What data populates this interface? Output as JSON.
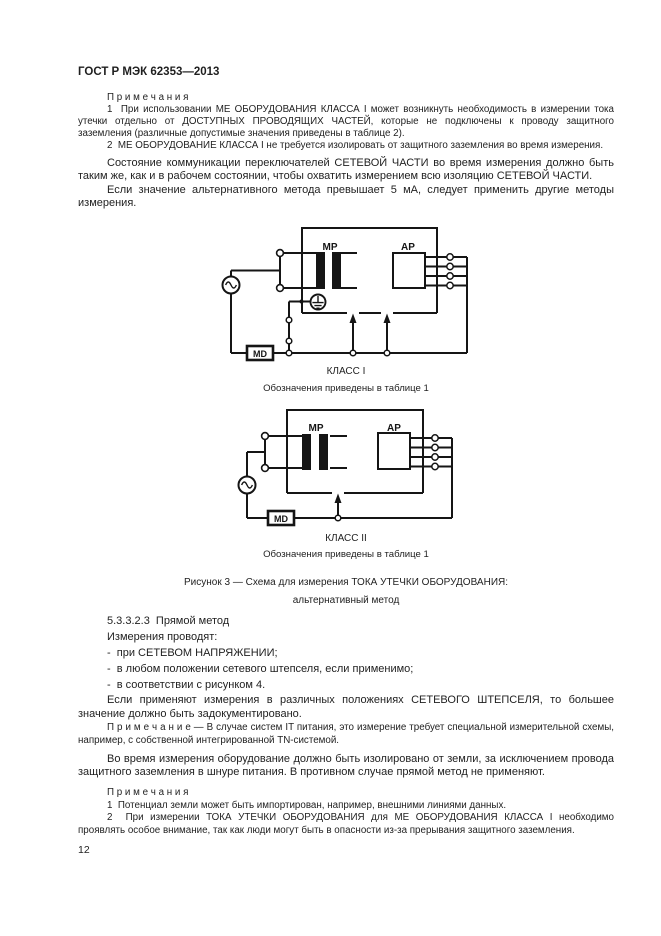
{
  "header": {
    "title": "ГОСТ Р МЭК 62353—2013"
  },
  "notes_top": {
    "label": "П р и м е ч а н и я",
    "items": [
      "1  При использовании МЕ ОБОРУДОВАНИЯ КЛАССА I может возникнуть необходимость в измерении тока утечки отдельно от ДОСТУПНЫХ ПРОВОДЯЩИХ ЧАСТЕЙ, которые не подключены к проводу защитного заземления (различные допустимые значения приведены в таблице 2).",
      "2  МЕ ОБОРУДОВАНИЕ КЛАССА I не требуется изолировать от защитного заземления во время измерения."
    ]
  },
  "para_switch": "Состояние коммуникации переключателей СЕТЕВОЙ ЧАСТИ во время измерения должно быть таким же, как и в рабочем состоянии, чтобы охватить измерением всю изоляцию СЕТЕВОЙ ЧАСТИ.",
  "para_5ma": "Если значение альтернативного метода превышает 5 мА, следует применить другие методы измерения.",
  "figure1": {
    "class_label": "КЛАСС I",
    "symbols_note": "Обозначения приведены в таблице 1",
    "labels": {
      "mp": "МР",
      "ap": "АР",
      "md": "MD"
    }
  },
  "figure2": {
    "class_label": "КЛАСС II",
    "symbols_note": "Обозначения приведены в таблице 1",
    "labels": {
      "mp": "МР",
      "ap": "АР",
      "md": "MD"
    }
  },
  "figure_caption": {
    "line1": "Рисунок 3 — Схема для измерения ТОКА УТЕЧКИ ОБОРУДОВАНИЯ:",
    "line2": "альтернативный метод"
  },
  "section": {
    "heading": "5.3.3.2.3  Прямой метод",
    "intro": "Измерения проводят:",
    "bullets": [
      "-  при СЕТЕВОМ НАПРЯЖЕНИИ;",
      "-  в любом положении сетевого штепселя, если применимо;",
      "-  в соответствии с рисунком 4."
    ],
    "para": "Если применяют измерения в различных положениях СЕТЕВОГО ШТЕПСЕЛЯ, то большее значение должно быть задокументировано."
  },
  "note_it": "П р и м е ч а н и е — В случае систем IT питания, это измерение требует специальной измерительной схемы, например, с собственной интегрированной TN-системой.",
  "para_isolated": "Во время измерения оборудование должно быть изолировано от земли, за исключением провода защитного заземления в шнуре питания. В противном случае прямой метод не применяют.",
  "notes_bottom": {
    "label": "П р и м е ч а н и я",
    "items": [
      "1  Потенциал земли может быть импортирован, например, внешними линиями данных.",
      "2  При измерении ТОКА УТЕЧКИ ОБОРУДОВАНИЯ для МЕ ОБОРУДОВАНИЯ КЛАССА I необходимо проявлять особое внимание, так как люди могут быть в опасности из-за прерывания защитного заземления."
    ]
  },
  "page_number": "12",
  "colors": {
    "ink": "#1f1f1f",
    "line": "#151515",
    "paper": "#ffffff"
  }
}
